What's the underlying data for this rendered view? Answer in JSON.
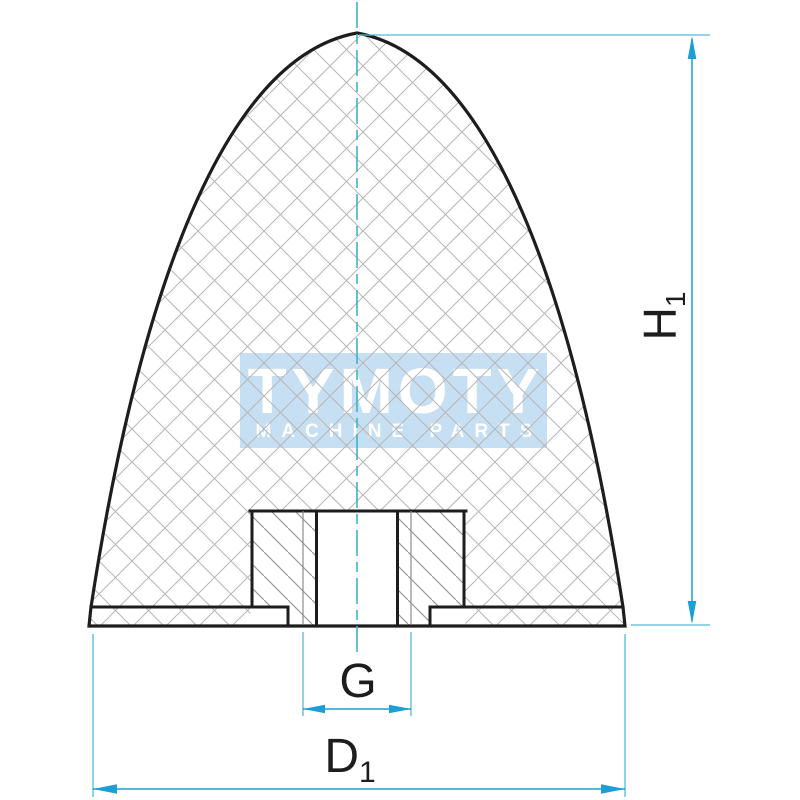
{
  "canvas": {
    "background": "#ffffff"
  },
  "watermark": {
    "brand": "TYMOTY",
    "tagline": "MACHINE PARTS",
    "box_color": "#c7dff2",
    "text_color": "#ffffff"
  },
  "dimensions": {
    "height": {
      "base": "H",
      "sub": "1"
    },
    "thread_label": "G",
    "diameter": {
      "base": "D",
      "sub": "1"
    }
  },
  "colors": {
    "outline": "#1d1d1d",
    "rubber_hatch": "#b6b6b6",
    "insert_hatch": "#9a9a9a",
    "thread_line": "#8c8c8c",
    "dimension": "#1b9fd6",
    "extension": "#55b8d9",
    "centerline": "#3db4c6",
    "label": "#1d1d1d"
  }
}
